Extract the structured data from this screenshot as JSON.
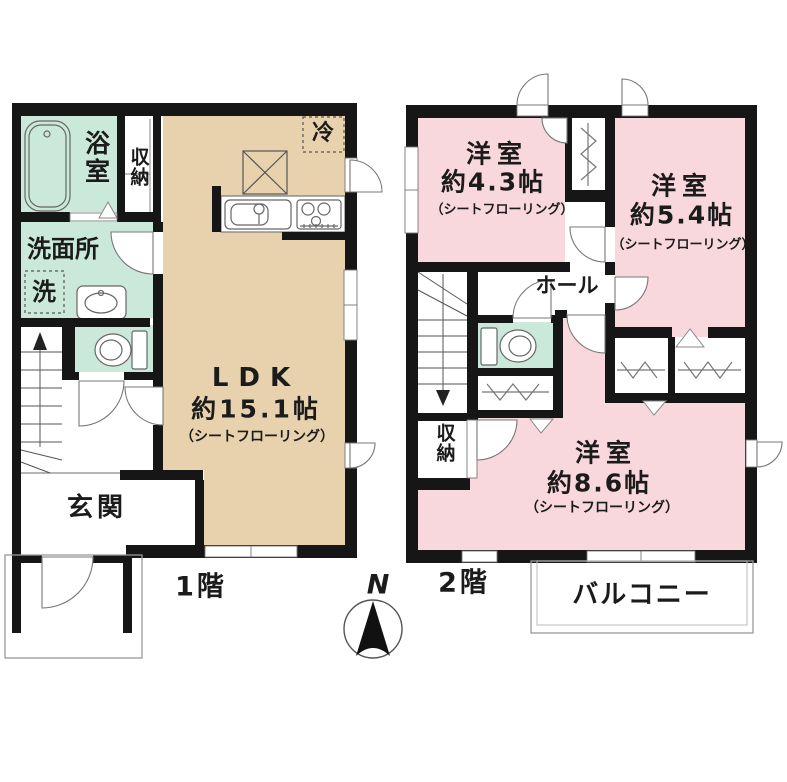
{
  "title": "間取り図",
  "floor1": {
    "label": "1階",
    "bath": "浴室",
    "bath_storage": "収納",
    "washroom": "洗面所",
    "washer": "洗",
    "fridge": "冷",
    "ldk": {
      "name": "LDK",
      "size": "約15.1帖",
      "flooring": "（シートフローリング）"
    },
    "entrance": "玄関"
  },
  "floor2": {
    "label": "2階",
    "room_a": {
      "name": "洋室",
      "size": "約4.3帖",
      "flooring": "（シートフローリング）"
    },
    "room_b": {
      "name": "洋室",
      "size": "約5.4帖",
      "flooring": "（シートフローリング）"
    },
    "room_c": {
      "name": "洋室",
      "size": "約8.6帖",
      "flooring": "（シートフローリング）"
    },
    "hall": "ホール",
    "storage": "収納",
    "balcony": "バルコニー"
  },
  "compass": {
    "north": "N"
  },
  "colors": {
    "wall": "#161616",
    "ldk_tan": "#e7d2ad",
    "bedroom_pink": "#f8d7dd",
    "wet_area_mint": "#cbe9da"
  }
}
